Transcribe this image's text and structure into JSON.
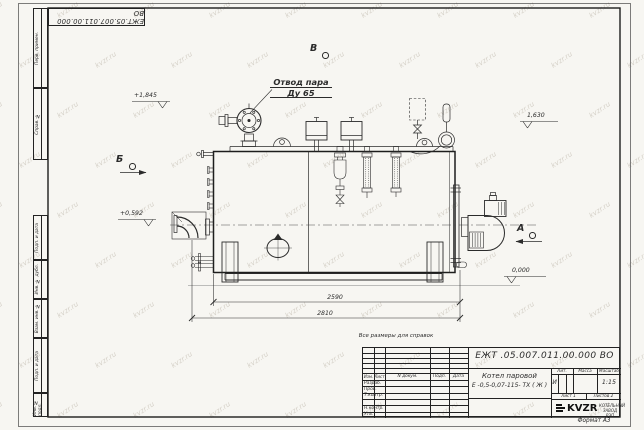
{
  "colors": {
    "ink": "#2b2b2b",
    "paper": "#f7f6f2",
    "watermark": "#968a76"
  },
  "watermark": {
    "text": "kvzr.ru"
  },
  "frame": {
    "top_stamp": "ЕЖТ.05.007.011.00.000  ВО",
    "format_note": "Формат А3",
    "margin_labels": {
      "perv_primen": "Перв. примен.",
      "sprav_no": "Справ. №",
      "podp_i_data_1": "Подп. и дата",
      "inv_no_dubl": "Инв. № дубл.",
      "vzam_inv_no": "Взам. инв. №",
      "podp_i_data_2": "Подп. и дата",
      "inv_no_podl": "Инв. № подл."
    }
  },
  "drawing": {
    "note": "Все размеры для справок",
    "callouts": {
      "steam_outlet": "Отвод пара",
      "steam_outlet_dn": "Ду 65"
    },
    "views": {
      "b": "Б",
      "v": "В",
      "a": "А"
    },
    "elevations": {
      "plus_1845": "+1,845",
      "plus_0592": "+0,592",
      "level_1630": "1,630",
      "level_0000": "0,000"
    },
    "dimensions": {
      "length_inner": "2590",
      "length_overall": "2810"
    }
  },
  "title_block": {
    "doc_number": "ЕЖТ .05.007.011.00.000  ВО",
    "product_name_line1": "Котел паровой",
    "product_name_line2": "Е -0,5-0,07-115- ТХ ( Ж )",
    "col_headers": {
      "izm": "Изм.",
      "list": "Лист",
      "n_dokum": "N докум.",
      "podp": "Подп.",
      "data": "Дата"
    },
    "row_labels": {
      "razrab": "Разраб.",
      "prov": "Пров.",
      "t_kontr": "Т.контр.",
      "n_kontr": "Н.контр.",
      "utv": "Утв."
    },
    "lit_header": "Лит.",
    "massa_header": "Масса",
    "masshtab_header": "Масштаб",
    "lit_value": "И",
    "scale": "1:15",
    "sheet": "Лист 1",
    "sheets": "Листов 2",
    "logo_text": "KVZR",
    "logo_sub_line1": "КОТЕЛЬНЫЙ",
    "logo_sub_line2": "ЗАВОД РЭП"
  }
}
